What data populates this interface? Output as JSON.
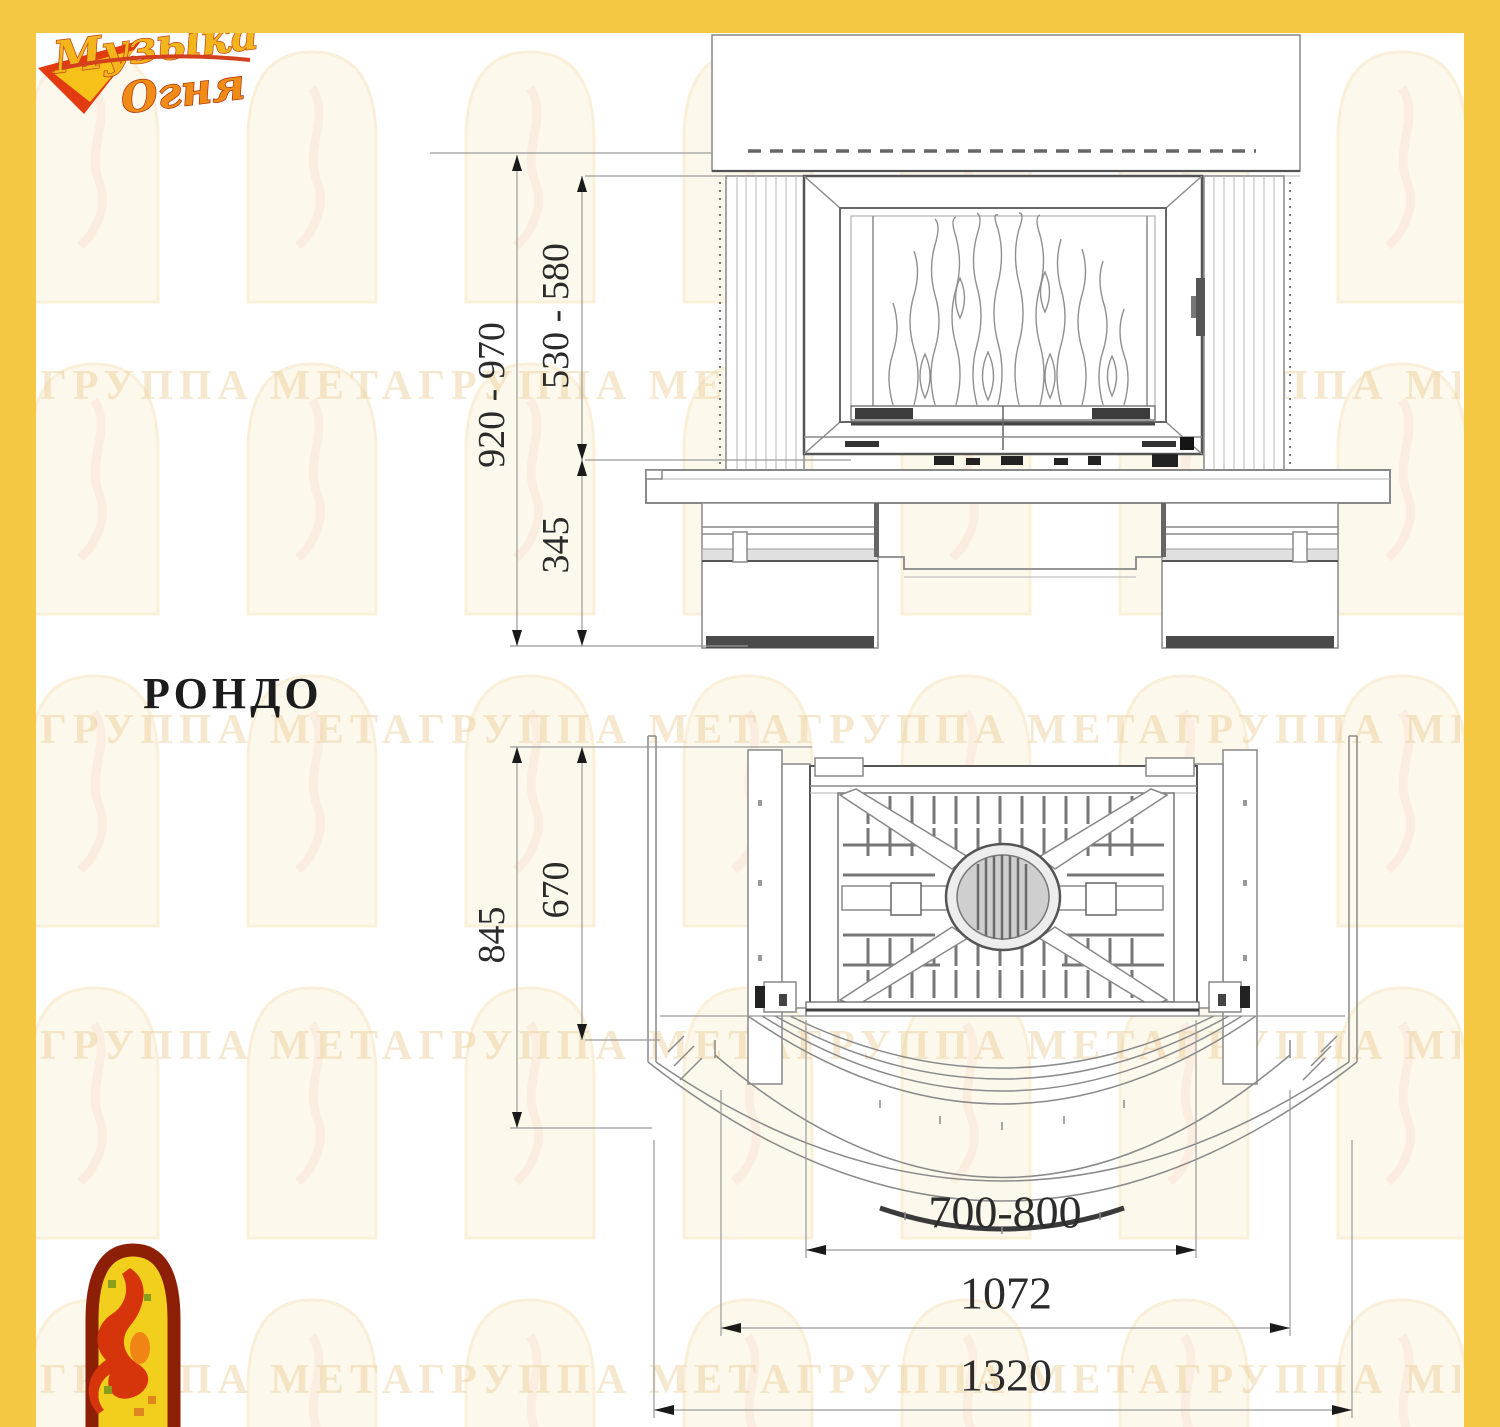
{
  "logo": {
    "line1": "Музыка",
    "line2": "Огня"
  },
  "title": "РОНДО",
  "watermark": {
    "row": "ГРУППА МЕТАГРУППА МЕТАГРУППА МЕТАГРУППА МЕТА"
  },
  "dimensions": {
    "front": {
      "total_height": "920 - 970",
      "opening_height": "530 - 580",
      "hearth_height": "345"
    },
    "plan": {
      "total_depth": "845",
      "inner_depth": "670",
      "opening_width": "700-800",
      "inner_width": "1072",
      "total_width": "1320"
    }
  },
  "colors": {
    "frame": "#f5c843",
    "line": "#8a8a8a",
    "dim_text": "#2b2b2b"
  }
}
